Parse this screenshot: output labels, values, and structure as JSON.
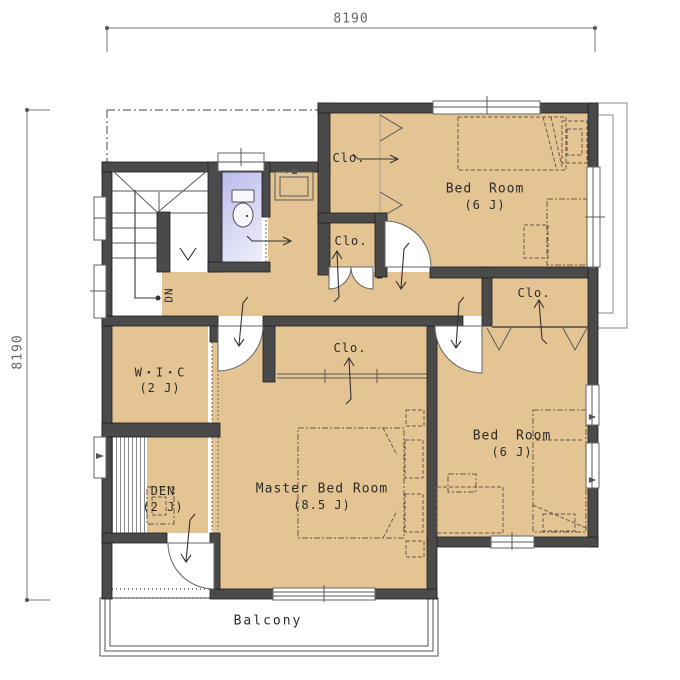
{
  "title": "Second floor plan",
  "dimensions": {
    "width_mm": "8190",
    "height_mm": "8190"
  },
  "labels": {
    "closet": "Clo.",
    "stairs_down": "DN"
  },
  "rooms": {
    "bedroom_top": {
      "name": "Bed Room",
      "size": "(6 J)"
    },
    "bedroom_right": {
      "name": "Bed Room",
      "size": "(6 J)"
    },
    "master": {
      "name": "Master Bed Room",
      "size": "(8.5 J)"
    },
    "wic": {
      "name": "W・I・C",
      "size": "(2 J)"
    },
    "den": {
      "name": "DEN",
      "size": "(2 J)"
    },
    "balcony": {
      "name": "Balcony"
    }
  },
  "colors": {
    "wall": "#4a4a4a",
    "wood_floor": "#e4c493",
    "toilet_floor": "#c9c9ef",
    "line": "#666666"
  }
}
